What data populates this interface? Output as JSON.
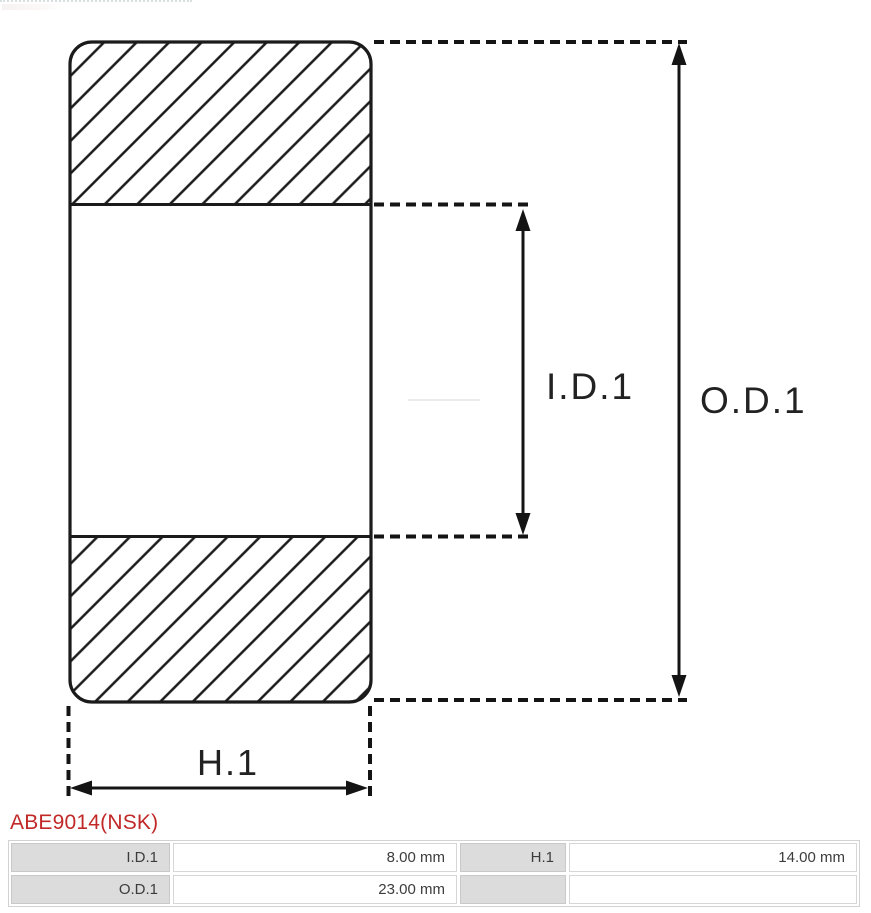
{
  "page": {
    "background": "#ffffff",
    "diagram_stroke": "#1b1b1b",
    "accent_red": "#c12928",
    "table_label_bg": "#dcdcdc"
  },
  "diagram": {
    "type": "bearing-cross-section",
    "labels": {
      "inner_diameter": "I.D.1",
      "outer_diameter": "O.D.1",
      "height": "H.1"
    }
  },
  "part_number": {
    "text": "ABE9014(NSK)"
  },
  "spec_table": {
    "rows": [
      [
        {
          "label": "I.D.1",
          "value": "8.00 mm"
        },
        {
          "label": "H.1",
          "value": "14.00 mm"
        }
      ],
      [
        {
          "label": "O.D.1",
          "value": "23.00 mm"
        },
        {
          "label": "",
          "value": ""
        }
      ]
    ]
  }
}
